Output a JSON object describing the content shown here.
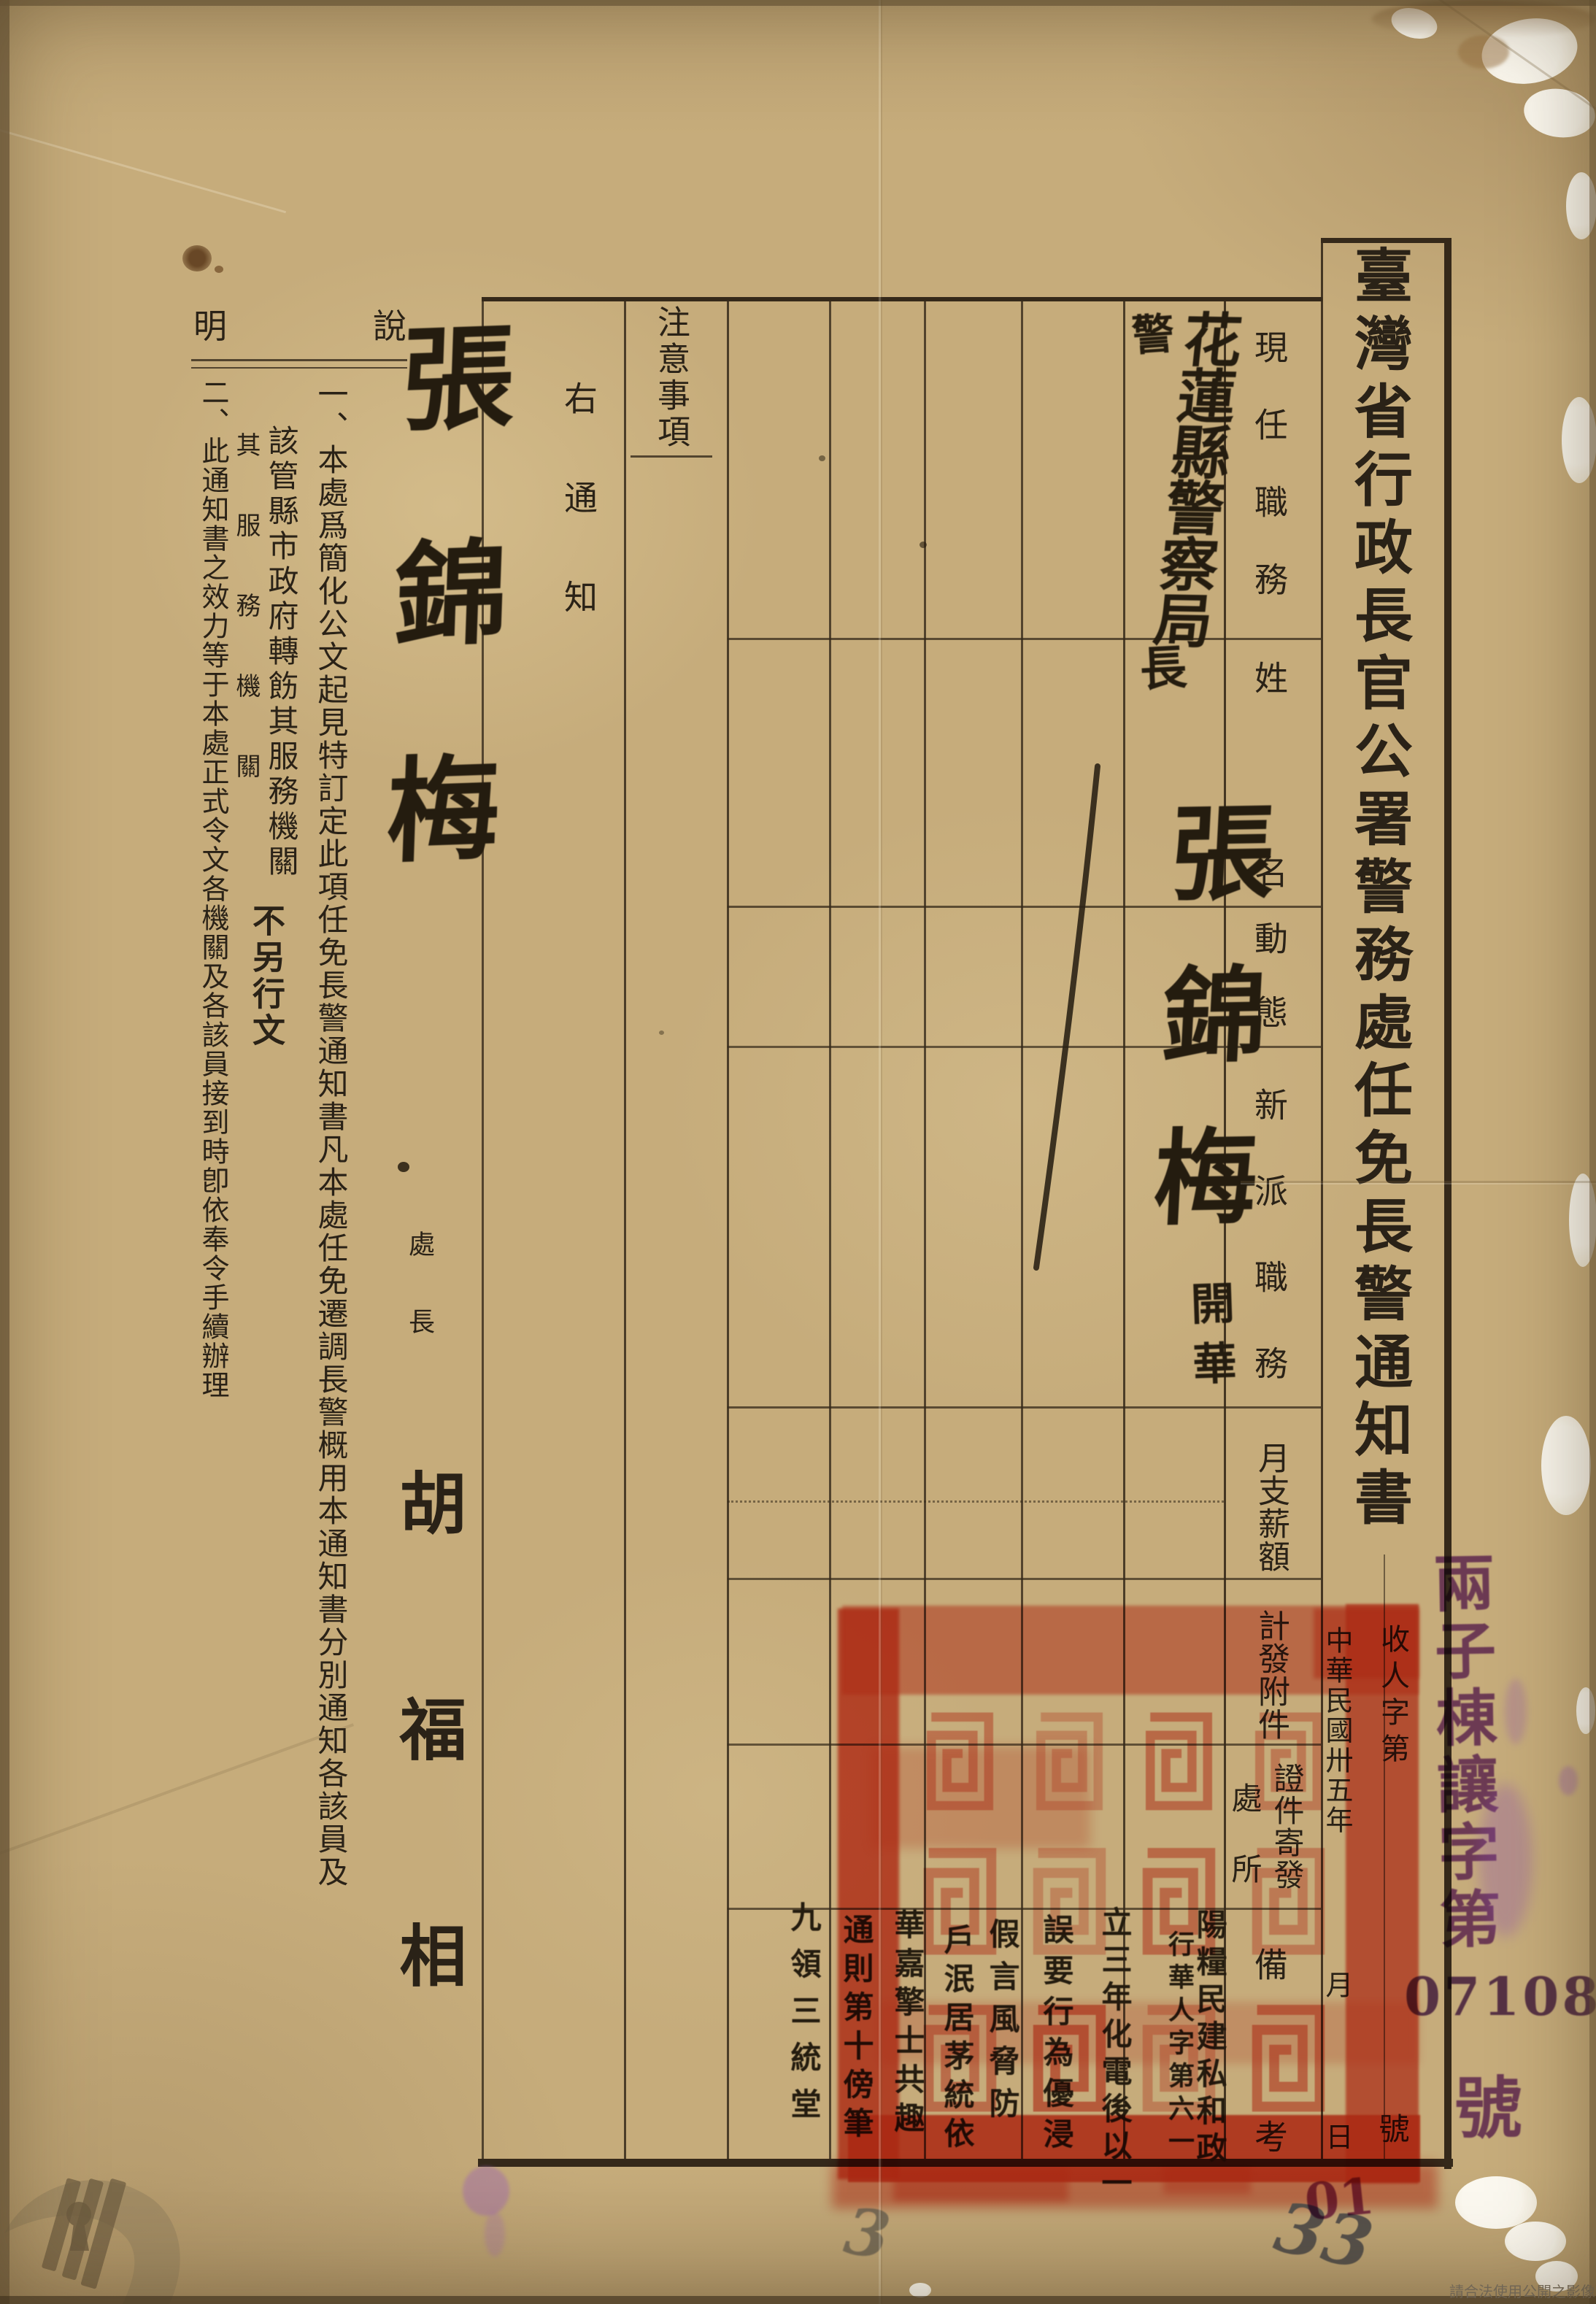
{
  "title": "臺灣省行政長官公署警務處任免長警通知書",
  "table": {
    "headers": {
      "current_position": "現任職務",
      "name": "姓名",
      "status": "動態",
      "new_position": "新派職務",
      "monthly_salary": "月支薪額",
      "attachments": "計發附件",
      "credentials_mailing": "證件寄發",
      "location": "處所",
      "remarks": "備考",
      "notes_column": "注意事項"
    }
  },
  "entry": {
    "position_prefix": "警",
    "current_position": "花蓮縣警察局",
    "position_suffix": "長",
    "name": "張錦梅",
    "status_note": "開華"
  },
  "filing": {
    "receipt_no_prefix": "收人字第",
    "receipt_no_suffix": "號",
    "date_line": "中華民國卅五年",
    "month_label": "月",
    "day_label": "日"
  },
  "notice": {
    "right_notice": "右通知",
    "notes_label_right": "說",
    "notes_label_left": "明",
    "item1_col1": "一、本處爲簡化公文起見特訂定此項任免長警通知書凡本處任免遷調長警概用本通知書分別通知各該員及",
    "item1_col2": "該管縣市政府轉飭其服務機關",
    "item1_small_note": "其服務機關",
    "item1_bold_note": "不另行文",
    "item2": "二、此通知書之效力等于本處正式令文各機關及各該員接到時卽依奉令手續辦理"
  },
  "signature": {
    "title": "處長",
    "name": "胡福相"
  },
  "handwriting": {
    "addressee_name": "張錦梅",
    "remark_columns": [
      "陽糧民建私和政",
      "行華人字第六一",
      "立三年化電後以一",
      "誤要行為優浸",
      "假言風脅防",
      "戶泯居茅統依",
      "華嘉擎士共趣",
      "通則第十傍筆",
      "九領三統堂"
    ],
    "pencil_marks": [
      "33",
      "3"
    ],
    "purple_mark": "01"
  },
  "stamps": {
    "purple_text": "兩子棟讓字第",
    "purple_number": "07108",
    "purple_suffix": "號"
  },
  "footer": {
    "usage_notice": "請合法使用公開之影像"
  },
  "colors": {
    "paper": "#c6ac7b",
    "ink": "#2a2217",
    "seal_red": "#dc3a24",
    "stamp_purple": "#7b3da1",
    "pencil": "#55504a"
  }
}
